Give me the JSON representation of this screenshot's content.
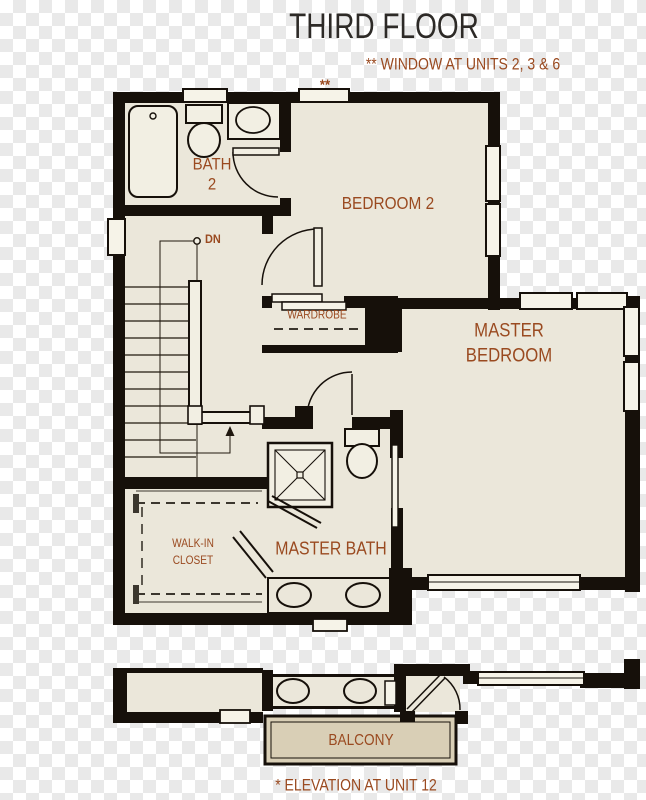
{
  "title": "THIRD FLOOR",
  "notes": {
    "window_marker": "**",
    "window_note": "** WINDOW AT UNITS 2, 3 & 6",
    "elevation_note": "* ELEVATION AT UNIT 12"
  },
  "rooms": {
    "bath2_line1": "BATH",
    "bath2_line2": "2",
    "bedroom2": "BEDROOM 2",
    "master_line1": "MASTER",
    "master_line2": "BEDROOM",
    "master_bath": "MASTER BATH",
    "closet_line1": "WALK-IN",
    "closet_line2": "CLOSET",
    "wardrobe": "WARDROBE",
    "balcony": "BALCONY",
    "stair_direction": "DN"
  },
  "colors": {
    "wall": "#16100a",
    "floor": "#ebe7da",
    "fixture_fill": "#f2efe3",
    "balcony_floor": "#d9cfb6",
    "label_brown": "#9a4a20",
    "title_dark": "#2d2a27",
    "checker_gray": "#e9e9e9"
  }
}
